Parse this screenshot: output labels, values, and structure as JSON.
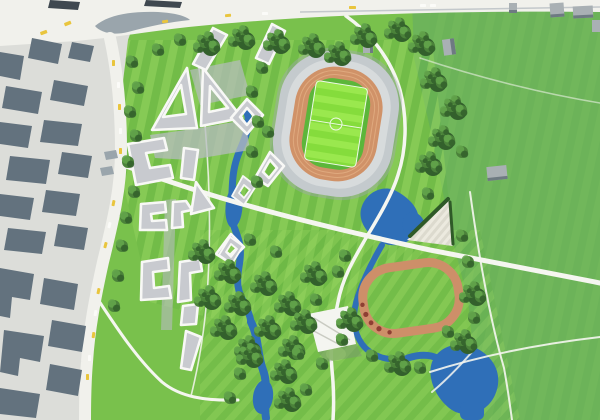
{
  "palette": {
    "park_green": "#79c14c",
    "park_stripe_light": "#97d65f",
    "park_stripe_dark": "#56a437",
    "field_green": "#6db45a",
    "tree_dark": "#33602c",
    "tree_mid": "#4b823a",
    "tree_light": "#63a44b",
    "water_blue": "#2f6fb8",
    "road_white": "#f1f1ec",
    "path_white": "#f5f6f0",
    "city_ground": "#dcddd9",
    "city_block": "#63727e",
    "city_block_dark": "#3f4850",
    "median_gray": "#9aa5ac",
    "stand_gray": "#c4cacd",
    "stand_light": "#d7dbdc",
    "track_salmon": "#d09268",
    "track_lane": "#dfa97e",
    "track_small": "#cd8f69",
    "pitch_green": "#85dc3c",
    "pitch_stripe": "#9ae84e",
    "pitch_margin": "#5cb63a",
    "roof_gray": "#c8cacf",
    "building_white": "#f8f8f6",
    "plaza_gray": "#b7bcc0",
    "car_yellow": "#e9c53d",
    "shed_gray": "#a9b0b4",
    "shed_dark": "#6e7a82",
    "hedge_dark": "#2f5a28",
    "canopy_white": "#f4f5f0",
    "shrub_red": "#8e3f33"
  },
  "scene": {
    "title": "aerial-masterplan-rendering",
    "city": "existing-city-blocks",
    "roads": "street-network",
    "development": "new-white-courtyard-buildings",
    "park": "landscape-park",
    "stadium": "athletics-stadium",
    "training_track": "training-running-track",
    "river": "river-and-ponds",
    "paths": "park-path-network",
    "amphitheater": "triangular-event-lawn",
    "canopy": "white-canopy-plaza",
    "fields": "open-green-fields",
    "sheds": "small-outbuildings",
    "trees": "trees",
    "cars": "vehicles"
  }
}
